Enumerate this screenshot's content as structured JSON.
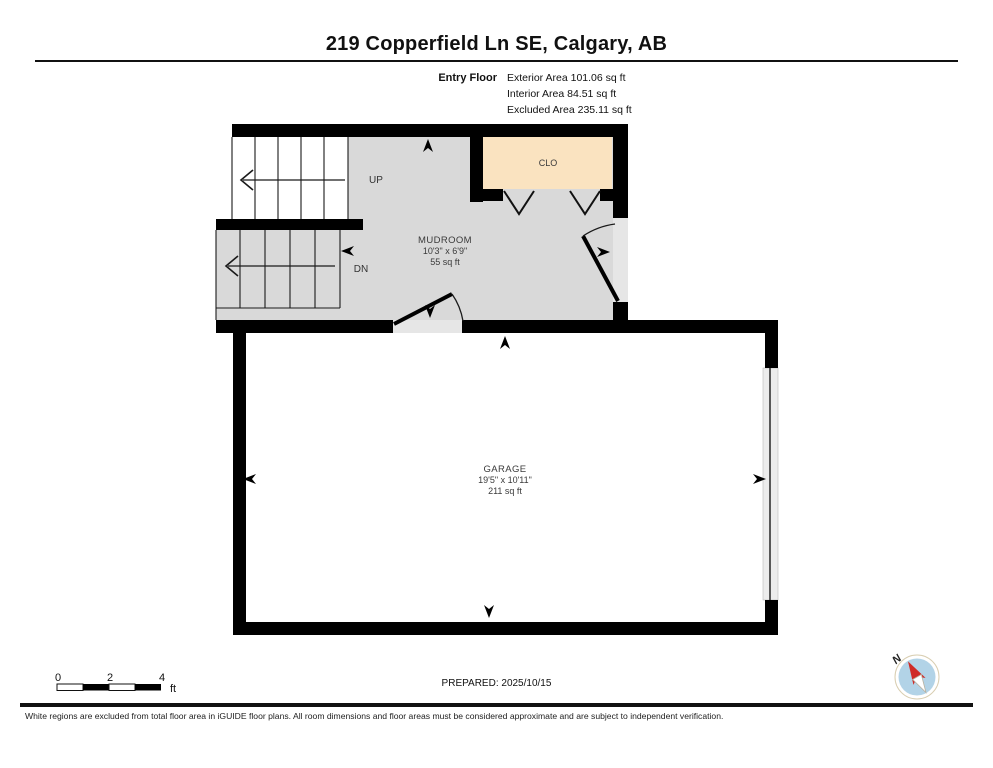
{
  "header": {
    "title": "219 Copperfield Ln SE, Calgary, AB",
    "floor_label": "Entry Floor",
    "area_lines": [
      "Exterior Area 101.06 sq ft",
      "Interior Area 84.51 sq ft",
      "Excluded Area 235.11 sq ft"
    ]
  },
  "rooms": {
    "mudroom": {
      "name": "MUDROOM",
      "dims": "10'3\" x 6'9\"",
      "area": "55 sq ft"
    },
    "closet": {
      "name": "CLO"
    },
    "garage": {
      "name": "GARAGE",
      "dims": "19'5\" x 10'11\"",
      "area": "211 sq ft"
    }
  },
  "stairs": {
    "up_label": "UP",
    "down_label": "DN"
  },
  "scale_bar": {
    "tick_labels": [
      "0",
      "2",
      "4"
    ],
    "unit": "ft"
  },
  "prepared_label": "PREPARED: 2025/10/15",
  "compass": {
    "north_label": "N"
  },
  "footer": {
    "disclaimer": "White regions are excluded from total floor area in iGUIDE floor plans. All room dimensions and floor areas must be considered approximate and are subject to independent verification."
  },
  "colors": {
    "wall": "#000000",
    "interior_floor": "#d9d9d9",
    "excluded_floor": "#ffffff",
    "closet_fill": "#fae3c0",
    "threshold": "#e6e6e6",
    "garage_door_strip": "#ececec",
    "compass_face": "#b2d3e7",
    "compass_ring": "#ece4cf",
    "compass_needle": "#cf2b27"
  }
}
